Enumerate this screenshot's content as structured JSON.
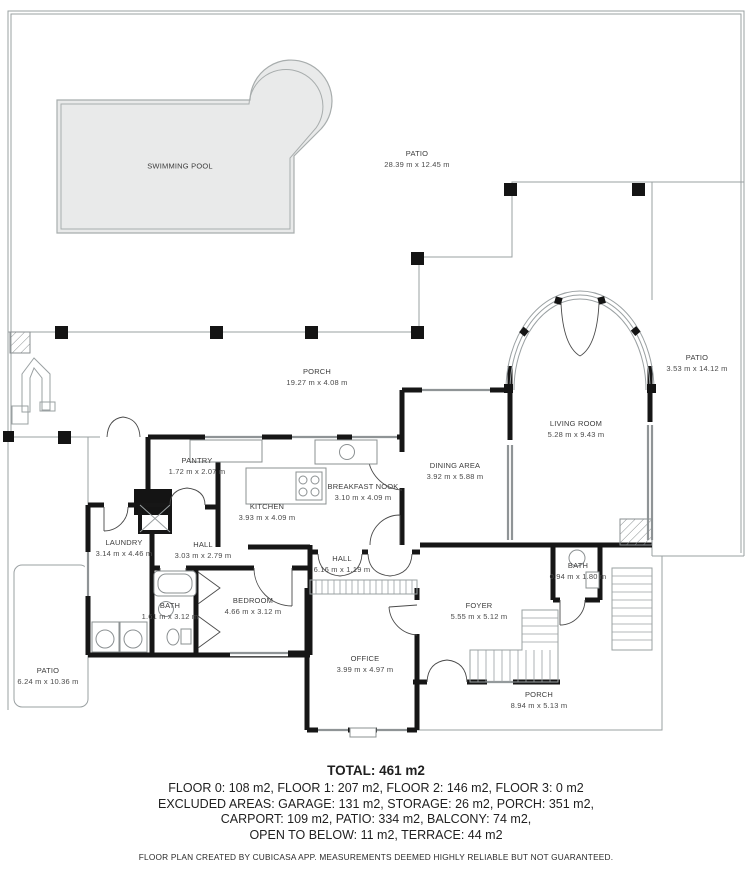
{
  "labels": {
    "swimming_pool": {
      "name": "SWIMMING POOL",
      "dims": ""
    },
    "patio_top": {
      "name": "PATIO",
      "dims": "28.39 m x 12.45 m"
    },
    "patio_right": {
      "name": "PATIO",
      "dims": "3.53 m x 14.12 m"
    },
    "porch_top": {
      "name": "PORCH",
      "dims": "19.27 m x 4.08 m"
    },
    "living_room": {
      "name": "LIVING ROOM",
      "dims": "5.28 m x 9.43 m"
    },
    "dining_area": {
      "name": "DINING AREA",
      "dims": "3.92 m x 5.88 m"
    },
    "breakfast_nook": {
      "name": "BREAKFAST NOOK",
      "dims": "3.10 m x 4.09 m"
    },
    "pantry": {
      "name": "PANTRY",
      "dims": "1.72 m x 2.07 m"
    },
    "kitchen": {
      "name": "KITCHEN",
      "dims": "3.93 m x 4.09 m"
    },
    "hall_small": {
      "name": "HALL",
      "dims": "3.03 m x 2.79 m"
    },
    "laundry": {
      "name": "LAUNDRY",
      "dims": "3.14 m x 4.46 m"
    },
    "bath_left": {
      "name": "BATH",
      "dims": "1.61 m x 3.12 m"
    },
    "bedroom": {
      "name": "BEDROOM",
      "dims": "4.66 m x 3.12 m"
    },
    "hall_long": {
      "name": "HALL",
      "dims": "6.16 m x 1.19 m"
    },
    "office": {
      "name": "OFFICE",
      "dims": "3.99 m x 4.97 m"
    },
    "foyer": {
      "name": "FOYER",
      "dims": "5.55 m x 5.12 m"
    },
    "bath_right": {
      "name": "BATH",
      "dims": "0.94 m x 1.80 m"
    },
    "porch_bottom": {
      "name": "PORCH",
      "dims": "8.94 m x 5.13 m"
    },
    "patio_left": {
      "name": "PATIO",
      "dims": "6.24 m x 10.36 m"
    }
  },
  "summary": {
    "total": "TOTAL: 461 m2",
    "line1": "FLOOR 0: 108 m2, FLOOR 1: 207 m2, FLOOR 2: 146 m2, FLOOR 3: 0 m2",
    "line2": "EXCLUDED AREAS: GARAGE: 131 m2, STORAGE: 26 m2, PORCH: 351 m2,",
    "line3": "CARPORT: 109 m2, PATIO: 334 m2, BALCONY: 74 m2,",
    "line4": "OPEN TO BELOW: 11 m2, TERRACE: 44 m2",
    "disclaimer": "FLOOR PLAN CREATED BY CUBICASA APP. MEASUREMENTS DEEMED HIGHLY RELIABLE BUT NOT GUARANTEED."
  }
}
